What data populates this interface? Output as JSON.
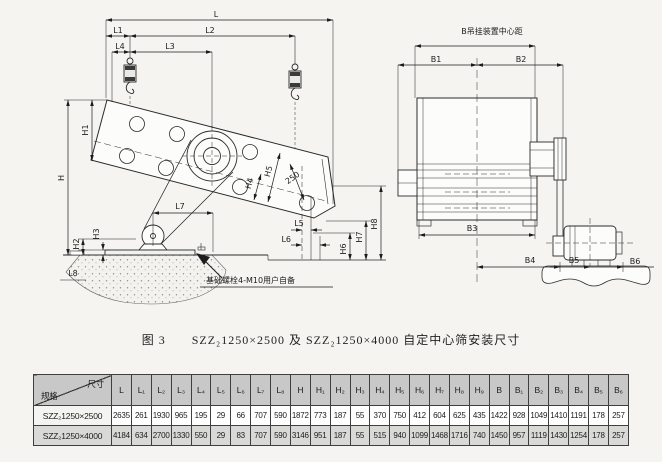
{
  "figure_caption": {
    "label": "图 3",
    "text": "SZZ₂1250×2500 及 SZZ₂1250×4000 自定中心筛安装尺寸"
  },
  "side_view": {
    "dim_labels": {
      "L": "L",
      "L1": "L1",
      "L2": "L2",
      "L3": "L3",
      "L4": "L4",
      "L5": "L5",
      "L6": "L6",
      "L7": "L7",
      "L8": "L8",
      "H": "H",
      "H1": "H1",
      "H2": "H2",
      "H3": "H3",
      "H4": "H4",
      "H5": "H5",
      "H6": "H6",
      "H7": "H7",
      "H8": "H8",
      "d250": "250"
    },
    "note": "基础螺栓4-M10用户自备"
  },
  "front_view": {
    "title": "B吊挂装置中心距",
    "dim_labels": {
      "B1": "B1",
      "B2": "B2",
      "B3": "B3",
      "B4": "B4",
      "B5": "B5",
      "B6": "B6"
    }
  },
  "table": {
    "corner_top": "尺寸",
    "corner_bottom": "规格",
    "columns": [
      "L",
      "L₁",
      "L₂",
      "L₃",
      "L₄",
      "L₅",
      "L₆",
      "L₇",
      "L₈",
      "H",
      "H₁",
      "H₂",
      "H₃",
      "H₄",
      "H₅",
      "H₆",
      "H₇",
      "H₈",
      "H₉",
      "B",
      "B₁",
      "B₂",
      "B₃",
      "B₄",
      "B₅",
      "B₆"
    ],
    "rows": [
      {
        "spec": "SZZ₂1250×2500",
        "values": [
          "2635",
          "261",
          "1930",
          "965",
          "195",
          "29",
          "66",
          "707",
          "590",
          "1872",
          "773",
          "187",
          "55",
          "370",
          "750",
          "412",
          "604",
          "625",
          "435",
          "1422",
          "928",
          "1049",
          "1410",
          "1191",
          "178",
          "257"
        ]
      },
      {
        "spec": "SZZ₂1250×4000",
        "values": [
          "4184",
          "634",
          "2700",
          "1330",
          "550",
          "29",
          "83",
          "707",
          "590",
          "3146",
          "951",
          "187",
          "55",
          "515",
          "940",
          "1099",
          "1468",
          "1716",
          "740",
          "1450",
          "957",
          "1119",
          "1430",
          "1254",
          "178",
          "257"
        ]
      }
    ]
  }
}
